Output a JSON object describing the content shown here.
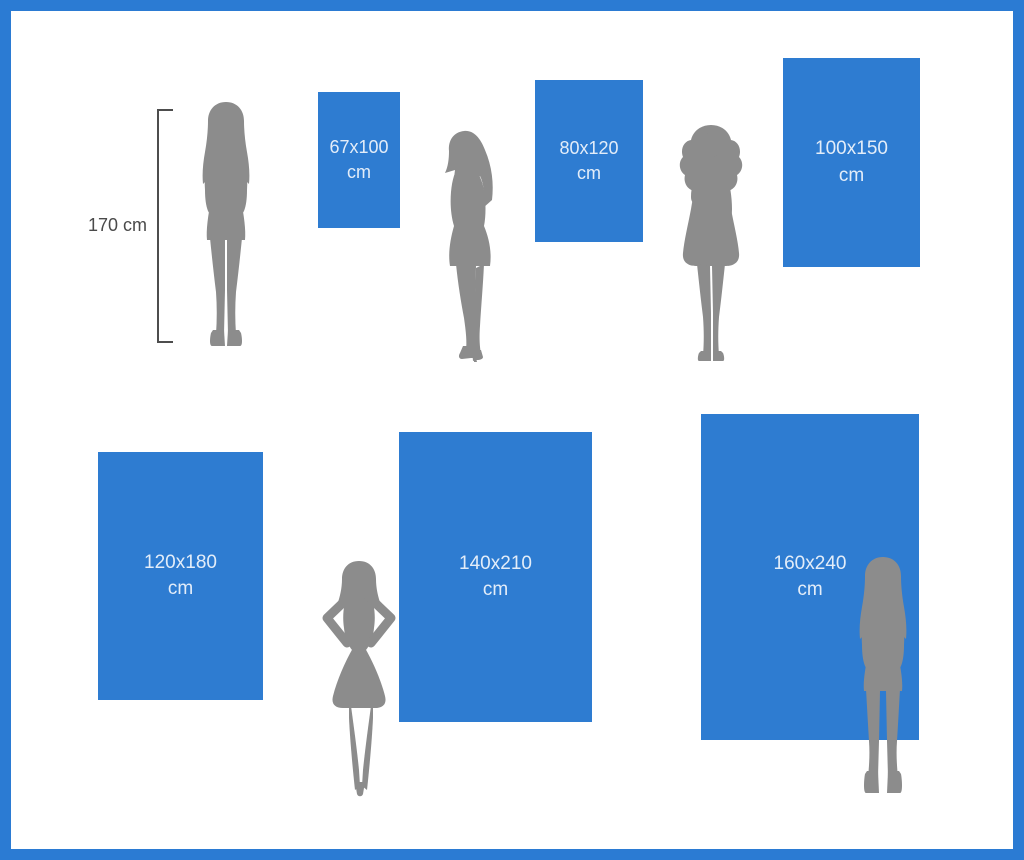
{
  "meta": {
    "description": "Poster/canvas size comparison infographic: six blue rectangles with dimensions in cm, gray female silhouettes (170 cm) shown for scale"
  },
  "colors": {
    "frame_blue": "#2B7BD3",
    "rect_blue": "#2E7CD1",
    "silhouette_gray": "#8C8C8C",
    "size_label_text": "#E3EDF9",
    "measure_text": "#4A4A4A",
    "background": "#FFFFFF"
  },
  "reference": {
    "height_label": "170 cm"
  },
  "sizes": [
    {
      "id": "size-67x100",
      "line1": "67x100",
      "line2": "cm",
      "width_cm": 67,
      "height_cm": 100
    },
    {
      "id": "size-80x120",
      "line1": "80x120",
      "line2": "cm",
      "width_cm": 80,
      "height_cm": 120
    },
    {
      "id": "size-100x150",
      "line1": "100x150",
      "line2": "cm",
      "width_cm": 100,
      "height_cm": 150
    },
    {
      "id": "size-120x180",
      "line1": "120x180",
      "line2": "cm",
      "width_cm": 120,
      "height_cm": 180
    },
    {
      "id": "size-140x210",
      "line1": "140x210",
      "line2": "cm",
      "width_cm": 140,
      "height_cm": 210
    },
    {
      "id": "size-160x240",
      "line1": "160x240",
      "line2": "cm",
      "width_cm": 160,
      "height_cm": 240
    }
  ],
  "figures": [
    {
      "icon": "woman-standing-front-silhouette-icon"
    },
    {
      "icon": "woman-profile-silhouette-icon"
    },
    {
      "icon": "woman-curly-hair-silhouette-icon"
    },
    {
      "icon": "woman-hands-on-hips-silhouette-icon"
    },
    {
      "icon": "woman-standing-boots-silhouette-icon"
    }
  ]
}
